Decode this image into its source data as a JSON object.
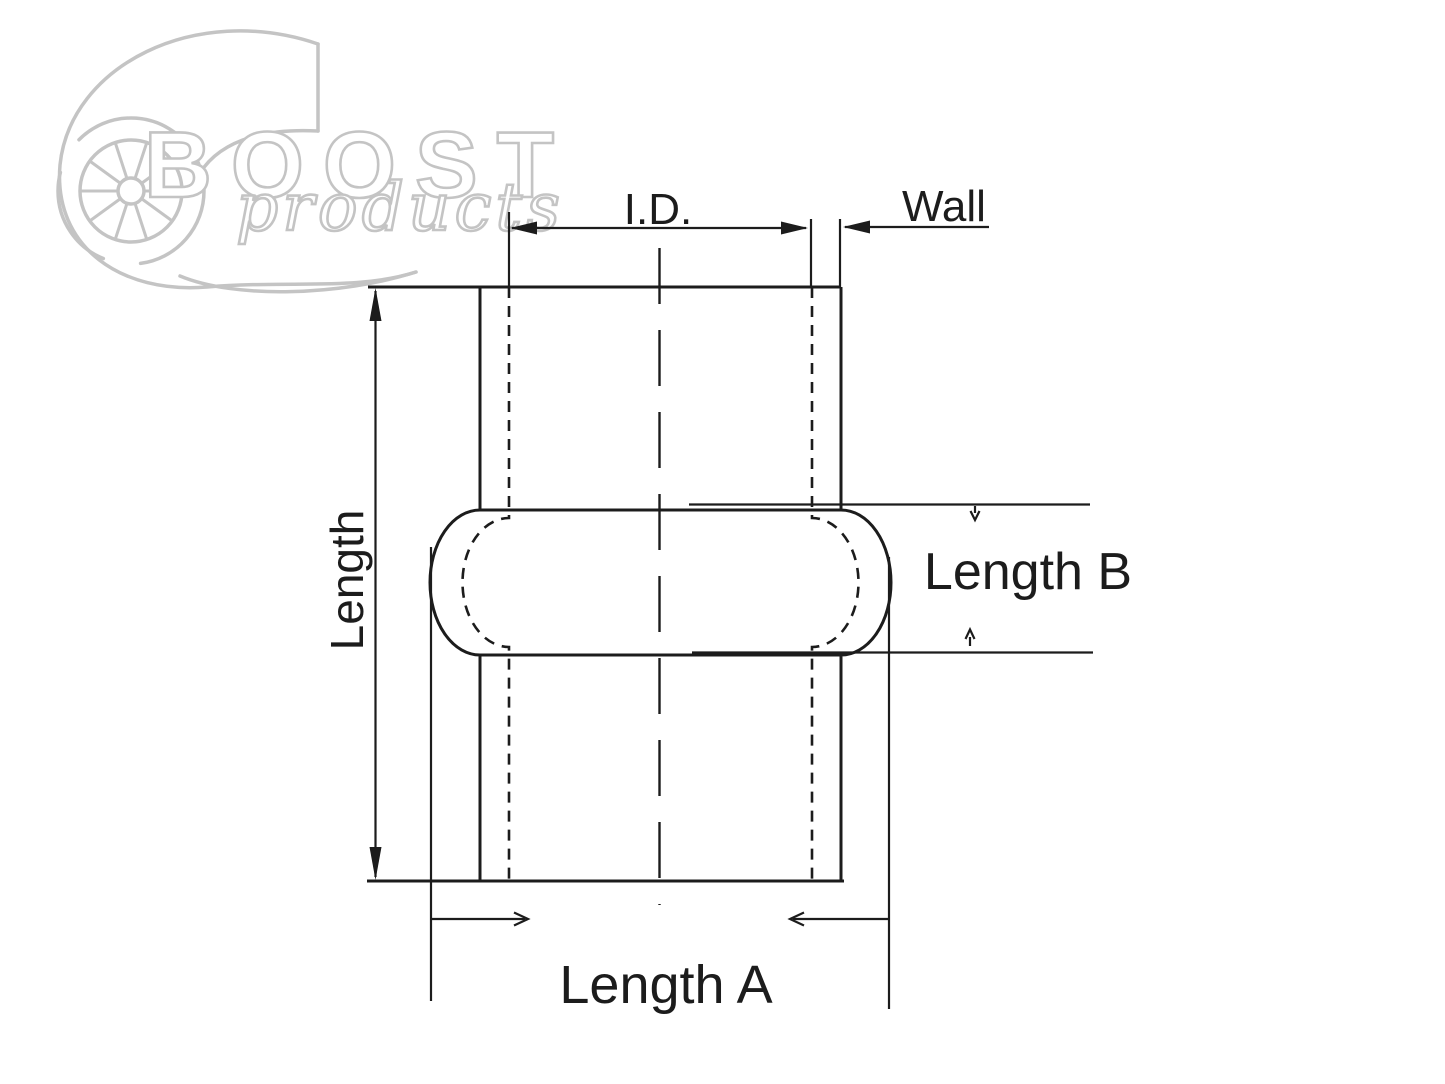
{
  "canvas": {
    "width": 1445,
    "height": 1084,
    "background": "#ffffff",
    "line_color": "#1c1c1c",
    "logo_color": "#c4c4c4"
  },
  "logo": {
    "brand": "BOOST",
    "sub_brand": "products",
    "icon": "turbocharger-wheel"
  },
  "diagram": {
    "type": "technical-dimension-drawing",
    "subject": "silicone hump coupler hose cross-section",
    "labels": {
      "inner_diameter": "I.D.",
      "wall": "Wall",
      "length": "Length",
      "length_a": "Length A",
      "length_b": "Length B"
    }
  }
}
